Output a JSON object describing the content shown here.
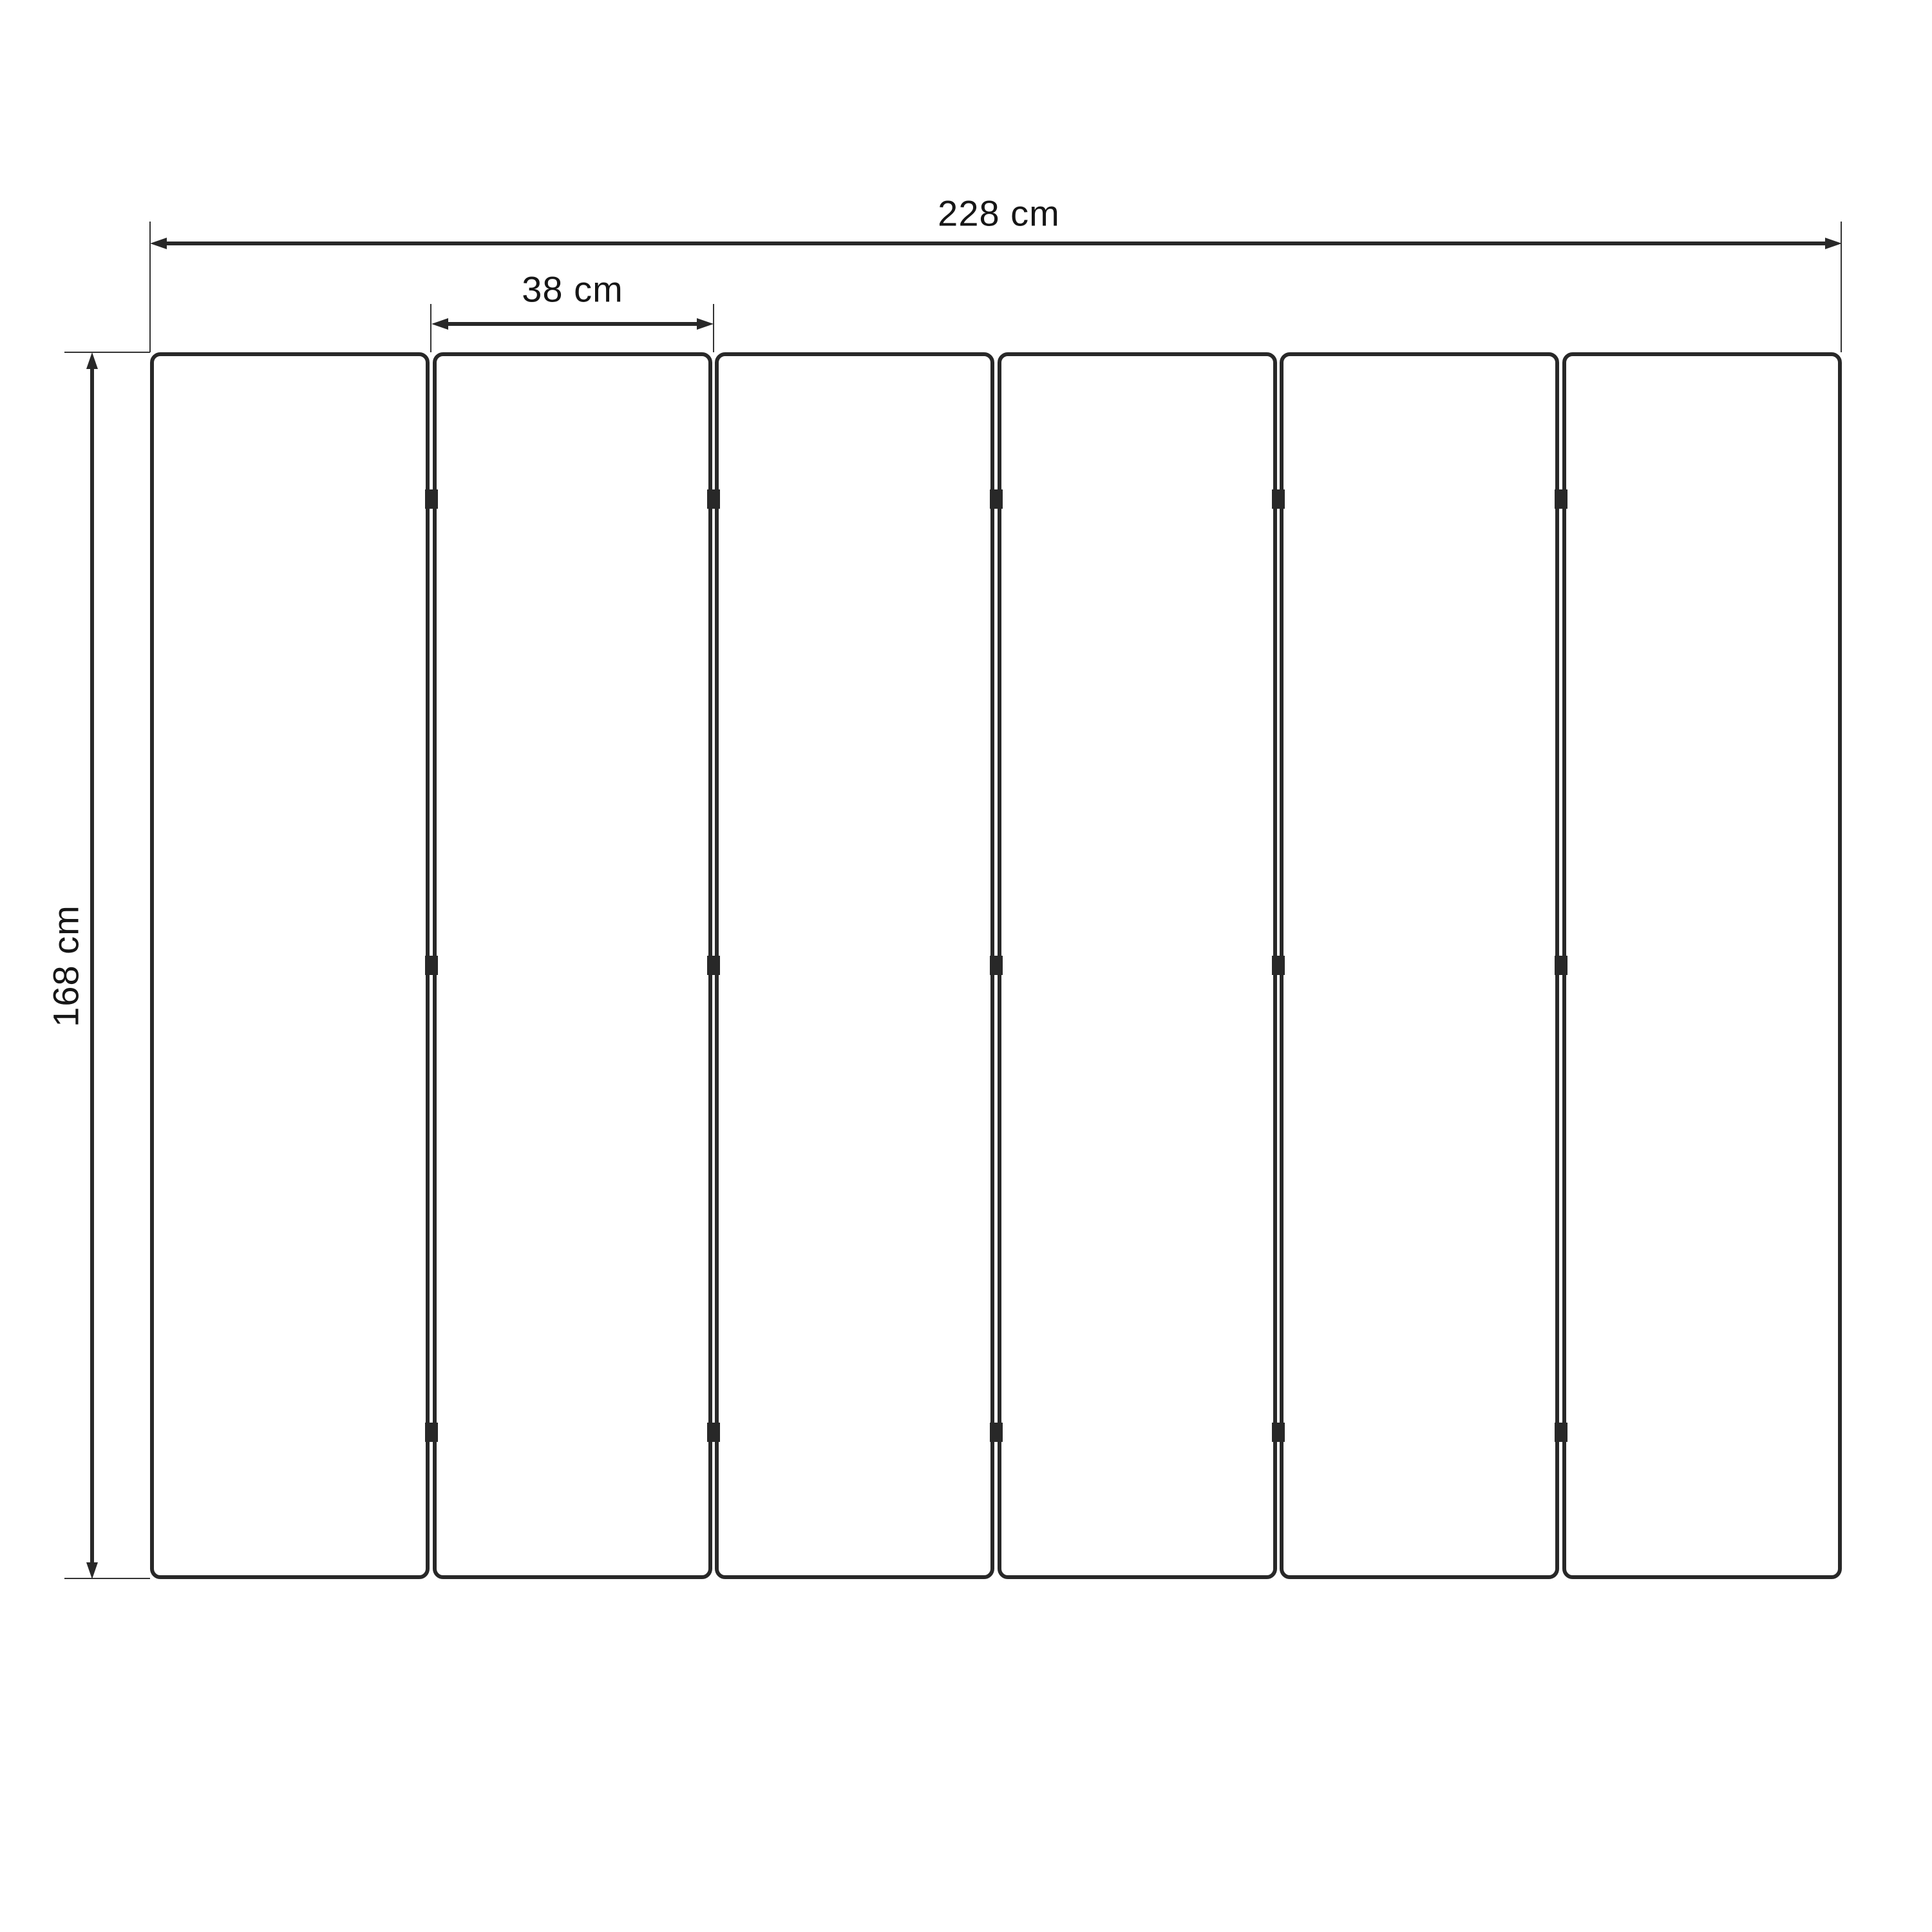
{
  "diagram": {
    "type": "technical-dimension-drawing",
    "subject": "six-panel folding screen front view",
    "panel_count": 6,
    "hinges_per_junction": 3,
    "colors": {
      "line": "#282828",
      "text": "#161616",
      "background": "#ffffff"
    },
    "dimensions": {
      "total_width": {
        "label": "228 cm",
        "value": 228,
        "unit": "cm"
      },
      "panel_width": {
        "label": "38 cm",
        "value": 38,
        "unit": "cm"
      },
      "height": {
        "label": "168 cm",
        "value": 168,
        "unit": "cm"
      }
    }
  }
}
